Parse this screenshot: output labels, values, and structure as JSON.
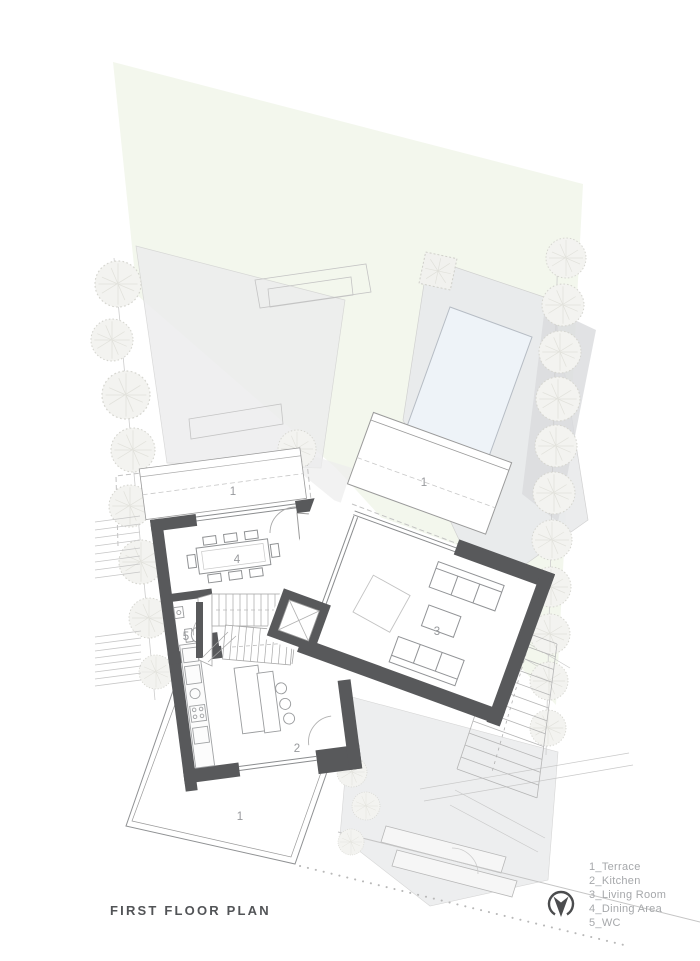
{
  "page": {
    "title": "FIRST FLOOR PLAN"
  },
  "legend": {
    "items": [
      "1_Terrace",
      "2_Kitchen",
      "3_Living Room",
      "4_Dining Area",
      "5_WC"
    ]
  },
  "rooms": {
    "terrace": {
      "number": "1",
      "label": "Terrace"
    },
    "kitchen": {
      "number": "2",
      "label": "Kitchen"
    },
    "living_room": {
      "number": "3",
      "label": "Living Room"
    },
    "dining_area": {
      "number": "4",
      "label": "Dining Area"
    },
    "wc": {
      "number": "5",
      "label": "WC"
    }
  },
  "icons": {
    "north_arrow": "north-arrow"
  },
  "colors": {
    "wall": "#58595b",
    "thin_line": "#8f9193",
    "site_gray": "#ececed",
    "deck_gray": "#e9eaec",
    "shadow_gray": "#dadbdd",
    "green_tint": "#f3f7ed",
    "pool_fill": "#eef3f8",
    "tree_stroke": "#d6d6d0",
    "label_text": "#97999c",
    "legend_text": "#a6a8ab",
    "title_text": "#525457"
  }
}
